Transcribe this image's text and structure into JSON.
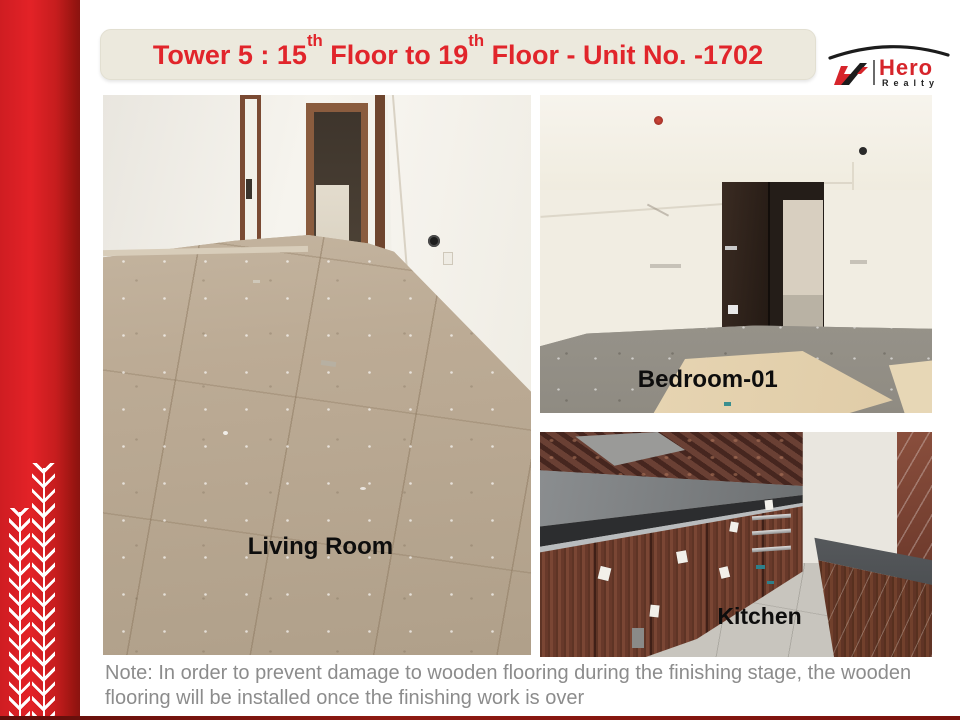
{
  "slide": {
    "title": {
      "part1": "Tower 5 : 15",
      "sup1": "th",
      "part2": " Floor to 19",
      "sup2": "th",
      "part3": " Floor - Unit No. -1702"
    },
    "logo": {
      "brand": "Hero",
      "sub": "Realty"
    },
    "photos": [
      {
        "label": "Living Room"
      },
      {
        "label": "Bedroom-01"
      },
      {
        "label": "Kitchen"
      }
    ],
    "note": "Note: In order to prevent damage to wooden flooring during the finishing stage, the wooden flooring will be installed once the finishing work is over",
    "colors": {
      "accent_red": "#e1252b",
      "band_red_bright": "#e32227",
      "band_red_dark": "#8a1310",
      "banner_bg": "#ece9dd",
      "note_gray": "#8c8c8c",
      "label_black": "#0d0d0d"
    }
  }
}
